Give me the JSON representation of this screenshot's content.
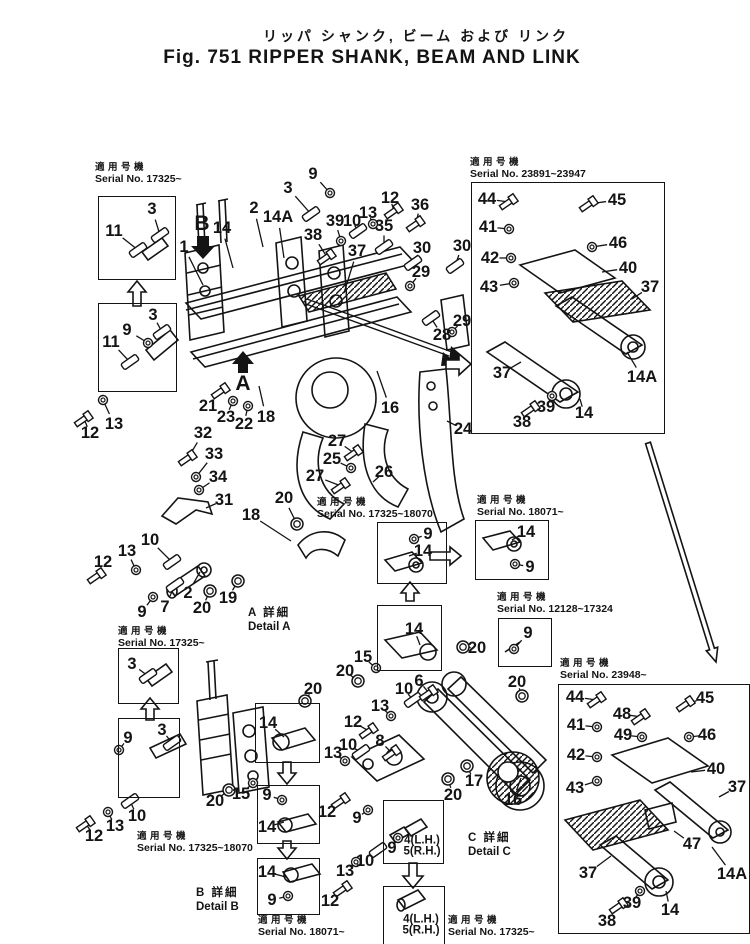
{
  "title": {
    "japanese": "リッパ シャンク, ビーム および リンク",
    "english": "Fig. 751 RIPPER SHANK, BEAM AND LINK"
  },
  "colors": {
    "ink": "#141414",
    "paper": "#ffffff"
  },
  "serial_labels": [
    {
      "jp": "適用号機",
      "sn": "Serial No. 17325~",
      "x": 95,
      "y": 162
    },
    {
      "jp": "適用号機",
      "sn": "Serial No. 23891~23947",
      "x": 470,
      "y": 157
    },
    {
      "jp": "適用号機",
      "sn": "Serial No. 17325~18070",
      "x": 317,
      "y": 497
    },
    {
      "jp": "適用号機",
      "sn": "Serial No. 18071~",
      "x": 477,
      "y": 495
    },
    {
      "jp": "適用号機",
      "sn": "Serial No. 12128~17324",
      "x": 497,
      "y": 592
    },
    {
      "jp": "適用号機",
      "sn": "Serial No. 23948~",
      "x": 560,
      "y": 658
    },
    {
      "jp": "適用号機",
      "sn": "Serial No. 17325~",
      "x": 118,
      "y": 626
    },
    {
      "jp": "適用号機",
      "sn": "Serial No. 17325~18070",
      "x": 137,
      "y": 831
    },
    {
      "jp": "適用号機",
      "sn": "Serial No. 18071~",
      "x": 258,
      "y": 915
    },
    {
      "jp": "適用号機",
      "sn": "Serial No. 17325~",
      "x": 448,
      "y": 915
    }
  ],
  "frames": [
    {
      "x": 98,
      "y": 196,
      "w": 76,
      "h": 82
    },
    {
      "x": 98,
      "y": 303,
      "w": 77,
      "h": 87
    },
    {
      "x": 471,
      "y": 182,
      "w": 192,
      "h": 250
    },
    {
      "x": 377,
      "y": 522,
      "w": 68,
      "h": 60
    },
    {
      "x": 475,
      "y": 520,
      "w": 72,
      "h": 58
    },
    {
      "x": 498,
      "y": 618,
      "w": 52,
      "h": 47
    },
    {
      "x": 558,
      "y": 684,
      "w": 190,
      "h": 248
    },
    {
      "x": 118,
      "y": 648,
      "w": 59,
      "h": 54
    },
    {
      "x": 118,
      "y": 718,
      "w": 60,
      "h": 78
    },
    {
      "x": 377,
      "y": 605,
      "w": 63,
      "h": 64
    },
    {
      "x": 255,
      "y": 703,
      "w": 63,
      "h": 58
    },
    {
      "x": 257,
      "y": 785,
      "w": 61,
      "h": 57
    },
    {
      "x": 257,
      "y": 858,
      "w": 61,
      "h": 55
    },
    {
      "x": 383,
      "y": 800,
      "w": 59,
      "h": 62
    },
    {
      "x": 383,
      "y": 886,
      "w": 60,
      "h": 57
    }
  ],
  "details": [
    {
      "jp": "A 詳細",
      "en": "Detail A",
      "x": 248,
      "y": 606
    },
    {
      "jp": "B 詳細",
      "en": "Detail B",
      "x": 196,
      "y": 886
    },
    {
      "jp": "C 詳細",
      "en": "Detail C",
      "x": 468,
      "y": 831
    }
  ],
  "view_markers": [
    {
      "label": "B",
      "x": 202,
      "y": 224
    },
    {
      "label": "A",
      "x": 243,
      "y": 384
    }
  ],
  "callouts": [
    {
      "t": "11",
      "x": 114,
      "y": 231,
      "lx": 138,
      "ly": 250,
      "g": "p"
    },
    {
      "t": "3",
      "x": 152,
      "y": 209,
      "lx": 160,
      "ly": 235,
      "g": "p"
    },
    {
      "t": "3",
      "x": 153,
      "y": 315,
      "lx": 162,
      "ly": 332,
      "g": "p"
    },
    {
      "t": "9",
      "x": 127,
      "y": 330,
      "lx": 148,
      "ly": 343,
      "g": "w"
    },
    {
      "t": "11",
      "x": 111,
      "y": 342,
      "lx": 130,
      "ly": 362,
      "g": "p"
    },
    {
      "t": "12",
      "x": 90,
      "y": 433,
      "lx": 84,
      "ly": 419,
      "g": "b"
    },
    {
      "t": "13",
      "x": 114,
      "y": 424,
      "lx": 103,
      "ly": 400,
      "g": "w"
    },
    {
      "t": "1",
      "x": 184,
      "y": 247,
      "lx": 203,
      "ly": 285
    },
    {
      "t": "14",
      "x": 222,
      "y": 228,
      "lx": 233,
      "ly": 268
    },
    {
      "t": "2",
      "x": 254,
      "y": 208,
      "lx": 263,
      "ly": 247
    },
    {
      "t": "14A",
      "x": 278,
      "y": 217,
      "lx": 284,
      "ly": 258
    },
    {
      "t": "3",
      "x": 288,
      "y": 188,
      "lx": 311,
      "ly": 214,
      "g": "p"
    },
    {
      "t": "9",
      "x": 313,
      "y": 174,
      "lx": 330,
      "ly": 193,
      "g": "w"
    },
    {
      "t": "10",
      "x": 352,
      "y": 221,
      "lx": 358,
      "ly": 231,
      "g": "p"
    },
    {
      "t": "13",
      "x": 368,
      "y": 213,
      "lx": 373,
      "ly": 224,
      "g": "w"
    },
    {
      "t": "12",
      "x": 390,
      "y": 198,
      "lx": 394,
      "ly": 211,
      "g": "b"
    },
    {
      "t": "36",
      "x": 420,
      "y": 205,
      "lx": 416,
      "ly": 224,
      "g": "b"
    },
    {
      "t": "35",
      "x": 384,
      "y": 226,
      "lx": 384,
      "ly": 247,
      "g": "p"
    },
    {
      "t": "39",
      "x": 335,
      "y": 221,
      "lx": 341,
      "ly": 241,
      "g": "w"
    },
    {
      "t": "38",
      "x": 313,
      "y": 235,
      "lx": 327,
      "ly": 257,
      "g": "b"
    },
    {
      "t": "37",
      "x": 357,
      "y": 251,
      "lx": 344,
      "ly": 293
    },
    {
      "t": "30",
      "x": 422,
      "y": 248,
      "lx": 413,
      "ly": 263,
      "g": "p"
    },
    {
      "t": "29",
      "x": 421,
      "y": 272,
      "lx": 410,
      "ly": 286,
      "g": "w"
    },
    {
      "t": "30",
      "x": 462,
      "y": 246,
      "lx": 455,
      "ly": 266,
      "g": "p"
    },
    {
      "t": "29",
      "x": 462,
      "y": 321,
      "lx": 452,
      "ly": 332,
      "g": "w"
    },
    {
      "t": "28",
      "x": 442,
      "y": 335,
      "lx": 431,
      "ly": 318,
      "g": "p"
    },
    {
      "t": "21",
      "x": 208,
      "y": 406,
      "lx": 221,
      "ly": 391,
      "g": "b"
    },
    {
      "t": "23",
      "x": 226,
      "y": 417,
      "lx": 233,
      "ly": 401,
      "g": "w"
    },
    {
      "t": "22",
      "x": 244,
      "y": 424,
      "lx": 248,
      "ly": 406,
      "g": "w"
    },
    {
      "t": "18",
      "x": 266,
      "y": 417,
      "lx": 259,
      "ly": 386
    },
    {
      "t": "16",
      "x": 390,
      "y": 408,
      "lx": 377,
      "ly": 371
    },
    {
      "t": "24",
      "x": 463,
      "y": 429,
      "lx": 447,
      "ly": 421
    },
    {
      "t": "32",
      "x": 203,
      "y": 433,
      "lx": 188,
      "ly": 458,
      "g": "b"
    },
    {
      "t": "33",
      "x": 214,
      "y": 454,
      "lx": 196,
      "ly": 477,
      "g": "w"
    },
    {
      "t": "34",
      "x": 218,
      "y": 477,
      "lx": 199,
      "ly": 490,
      "g": "w"
    },
    {
      "t": "31",
      "x": 224,
      "y": 500,
      "lx": 206,
      "ly": 508
    },
    {
      "t": "20",
      "x": 284,
      "y": 498,
      "lx": 297,
      "ly": 524,
      "g": "r"
    },
    {
      "t": "18",
      "x": 251,
      "y": 515,
      "lx": 291,
      "ly": 541
    },
    {
      "t": "27",
      "x": 337,
      "y": 441,
      "lx": 354,
      "ly": 453,
      "g": "b"
    },
    {
      "t": "25",
      "x": 332,
      "y": 459,
      "lx": 351,
      "ly": 468,
      "g": "w"
    },
    {
      "t": "27",
      "x": 315,
      "y": 476,
      "lx": 341,
      "ly": 486,
      "g": "b"
    },
    {
      "t": "26",
      "x": 384,
      "y": 472,
      "lx": 373,
      "ly": 482
    },
    {
      "t": "12",
      "x": 103,
      "y": 562,
      "lx": 97,
      "ly": 576,
      "g": "b"
    },
    {
      "t": "13",
      "x": 127,
      "y": 551,
      "lx": 136,
      "ly": 570,
      "g": "w"
    },
    {
      "t": "10",
      "x": 150,
      "y": 540,
      "lx": 172,
      "ly": 562,
      "g": "p"
    },
    {
      "t": "9",
      "x": 142,
      "y": 612,
      "lx": 153,
      "ly": 597,
      "g": "w"
    },
    {
      "t": "7",
      "x": 165,
      "y": 607,
      "lx": 175,
      "ly": 585,
      "g": "p"
    },
    {
      "t": "2",
      "x": 188,
      "y": 593,
      "lx": 200,
      "ly": 572
    },
    {
      "t": "20",
      "x": 202,
      "y": 608,
      "lx": 210,
      "ly": 591,
      "g": "r"
    },
    {
      "t": "19",
      "x": 228,
      "y": 598,
      "lx": 238,
      "ly": 581,
      "g": "r"
    },
    {
      "t": "9",
      "x": 428,
      "y": 534,
      "lx": 414,
      "ly": 539,
      "g": "w"
    },
    {
      "t": "14",
      "x": 423,
      "y": 551,
      "lx": 409,
      "ly": 556
    },
    {
      "t": "14",
      "x": 526,
      "y": 532,
      "lx": 512,
      "ly": 540
    },
    {
      "t": "9",
      "x": 530,
      "y": 567,
      "lx": 515,
      "ly": 564,
      "g": "w"
    },
    {
      "t": "9",
      "x": 528,
      "y": 633,
      "lx": 514,
      "ly": 649,
      "g": "w"
    },
    {
      "t": "14",
      "x": 414,
      "y": 629,
      "lx": 420,
      "ly": 645
    },
    {
      "t": "20",
      "x": 477,
      "y": 648,
      "lx": 463,
      "ly": 647,
      "g": "r"
    },
    {
      "t": "15",
      "x": 363,
      "y": 657,
      "lx": 376,
      "ly": 668,
      "g": "w"
    },
    {
      "t": "20",
      "x": 345,
      "y": 671,
      "lx": 358,
      "ly": 681,
      "g": "r"
    },
    {
      "t": "10",
      "x": 404,
      "y": 689,
      "lx": 413,
      "ly": 700,
      "g": "p"
    },
    {
      "t": "6",
      "x": 419,
      "y": 681,
      "lx": 429,
      "ly": 693,
      "g": "b"
    },
    {
      "t": "13",
      "x": 380,
      "y": 706,
      "lx": 391,
      "ly": 716,
      "g": "w"
    },
    {
      "t": "12",
      "x": 353,
      "y": 722,
      "lx": 369,
      "ly": 731,
      "g": "b"
    },
    {
      "t": "10",
      "x": 348,
      "y": 745,
      "lx": 361,
      "ly": 752,
      "g": "p"
    },
    {
      "t": "13",
      "x": 333,
      "y": 753,
      "lx": 345,
      "ly": 761,
      "g": "w"
    },
    {
      "t": "8",
      "x": 380,
      "y": 741,
      "lx": 392,
      "ly": 753,
      "g": "b"
    },
    {
      "t": "17",
      "x": 474,
      "y": 781,
      "lx": 467,
      "ly": 766,
      "g": "r"
    },
    {
      "t": "20",
      "x": 453,
      "y": 795,
      "lx": 448,
      "ly": 779,
      "g": "r"
    },
    {
      "t": "16",
      "x": 513,
      "y": 800,
      "lx": 521,
      "ly": 778
    },
    {
      "t": "20",
      "x": 517,
      "y": 682,
      "lx": 522,
      "ly": 696,
      "g": "r"
    },
    {
      "t": "9",
      "x": 357,
      "y": 818,
      "lx": 368,
      "ly": 810,
      "g": "w"
    },
    {
      "t": "12",
      "x": 327,
      "y": 812,
      "lx": 341,
      "ly": 801,
      "g": "b"
    },
    {
      "t": "10",
      "x": 365,
      "y": 861,
      "lx": 378,
      "ly": 850,
      "g": "p"
    },
    {
      "t": "13",
      "x": 345,
      "y": 871,
      "lx": 356,
      "ly": 862,
      "g": "w"
    },
    {
      "t": "12",
      "x": 330,
      "y": 901,
      "lx": 343,
      "ly": 889,
      "g": "b"
    },
    {
      "t": "20",
      "x": 313,
      "y": 689,
      "lx": 305,
      "ly": 701,
      "g": "r"
    },
    {
      "t": "14",
      "x": 268,
      "y": 723,
      "lx": 284,
      "ly": 737
    },
    {
      "t": "15",
      "x": 241,
      "y": 794,
      "lx": 253,
      "ly": 783,
      "g": "w"
    },
    {
      "t": "20",
      "x": 215,
      "y": 801,
      "lx": 229,
      "ly": 790,
      "g": "r"
    },
    {
      "t": "9",
      "x": 267,
      "y": 795,
      "lx": 282,
      "ly": 800,
      "g": "w"
    },
    {
      "t": "14",
      "x": 267,
      "y": 827,
      "lx": 284,
      "ly": 822
    },
    {
      "t": "14",
      "x": 267,
      "y": 872,
      "lx": 286,
      "ly": 877
    },
    {
      "t": "9",
      "x": 272,
      "y": 900,
      "lx": 288,
      "ly": 896,
      "g": "w"
    },
    {
      "t": "3",
      "x": 132,
      "y": 664,
      "lx": 148,
      "ly": 676,
      "g": "p"
    },
    {
      "t": "9",
      "x": 128,
      "y": 738,
      "lx": 119,
      "ly": 750,
      "g": "w"
    },
    {
      "t": "3",
      "x": 162,
      "y": 730,
      "lx": 172,
      "ly": 743,
      "g": "p"
    },
    {
      "t": "12",
      "x": 94,
      "y": 836,
      "lx": 86,
      "ly": 824,
      "g": "b"
    },
    {
      "t": "13",
      "x": 115,
      "y": 826,
      "lx": 108,
      "ly": 812,
      "g": "w"
    },
    {
      "t": "10",
      "x": 137,
      "y": 816,
      "lx": 130,
      "ly": 801,
      "g": "p"
    },
    {
      "t": "9",
      "x": 392,
      "y": 848,
      "lx": 398,
      "ly": 838,
      "g": "w"
    },
    {
      "t": "4(L.H.)",
      "x": 422,
      "y": 841,
      "s": 1
    },
    {
      "t": "5(R.H.)",
      "x": 422,
      "y": 852,
      "s": 1
    },
    {
      "t": "4(L.H.)",
      "x": 421,
      "y": 920,
      "s": 1
    },
    {
      "t": "5(R.H.)",
      "x": 421,
      "y": 931,
      "s": 1
    },
    {
      "t": "44",
      "x": 487,
      "y": 199,
      "lx": 509,
      "ly": 202,
      "g": "b"
    },
    {
      "t": "45",
      "x": 617,
      "y": 200,
      "lx": 589,
      "ly": 204,
      "g": "b"
    },
    {
      "t": "41",
      "x": 488,
      "y": 227,
      "lx": 509,
      "ly": 229,
      "g": "w"
    },
    {
      "t": "46",
      "x": 618,
      "y": 243,
      "lx": 592,
      "ly": 247,
      "g": "w"
    },
    {
      "t": "42",
      "x": 490,
      "y": 258,
      "lx": 511,
      "ly": 258,
      "g": "w"
    },
    {
      "t": "40",
      "x": 628,
      "y": 268,
      "lx": 602,
      "ly": 272
    },
    {
      "t": "43",
      "x": 489,
      "y": 287,
      "lx": 514,
      "ly": 283,
      "g": "w"
    },
    {
      "t": "37",
      "x": 650,
      "y": 287,
      "lx": 632,
      "ly": 299
    },
    {
      "t": "37",
      "x": 502,
      "y": 373,
      "lx": 521,
      "ly": 362
    },
    {
      "t": "38",
      "x": 522,
      "y": 422,
      "lx": 531,
      "ly": 409,
      "g": "b"
    },
    {
      "t": "39",
      "x": 546,
      "y": 407,
      "lx": 552,
      "ly": 396,
      "g": "w"
    },
    {
      "t": "14",
      "x": 584,
      "y": 413,
      "lx": 580,
      "ly": 399
    },
    {
      "t": "14A",
      "x": 642,
      "y": 377,
      "lx": 627,
      "ly": 352
    },
    {
      "t": "44",
      "x": 575,
      "y": 697,
      "lx": 597,
      "ly": 700,
      "g": "b"
    },
    {
      "t": "48",
      "x": 622,
      "y": 714,
      "lx": 641,
      "ly": 717,
      "g": "b"
    },
    {
      "t": "45",
      "x": 705,
      "y": 698,
      "lx": 686,
      "ly": 704,
      "g": "b"
    },
    {
      "t": "41",
      "x": 576,
      "y": 725,
      "lx": 597,
      "ly": 727,
      "g": "w"
    },
    {
      "t": "49",
      "x": 623,
      "y": 735,
      "lx": 642,
      "ly": 737,
      "g": "w"
    },
    {
      "t": "46",
      "x": 707,
      "y": 735,
      "lx": 689,
      "ly": 737,
      "g": "w"
    },
    {
      "t": "42",
      "x": 576,
      "y": 755,
      "lx": 597,
      "ly": 757,
      "g": "w"
    },
    {
      "t": "40",
      "x": 716,
      "y": 769,
      "lx": 691,
      "ly": 772
    },
    {
      "t": "43",
      "x": 575,
      "y": 788,
      "lx": 597,
      "ly": 781,
      "g": "w"
    },
    {
      "t": "37",
      "x": 737,
      "y": 787,
      "lx": 719,
      "ly": 797
    },
    {
      "t": "37",
      "x": 588,
      "y": 873,
      "lx": 611,
      "ly": 856
    },
    {
      "t": "38",
      "x": 607,
      "y": 921,
      "lx": 619,
      "ly": 906,
      "g": "b"
    },
    {
      "t": "39",
      "x": 632,
      "y": 903,
      "lx": 640,
      "ly": 891,
      "g": "w"
    },
    {
      "t": "14",
      "x": 670,
      "y": 910,
      "lx": 666,
      "ly": 891
    },
    {
      "t": "47",
      "x": 692,
      "y": 844,
      "lx": 674,
      "ly": 831
    },
    {
      "t": "14A",
      "x": 732,
      "y": 874,
      "lx": 712,
      "ly": 847
    }
  ]
}
